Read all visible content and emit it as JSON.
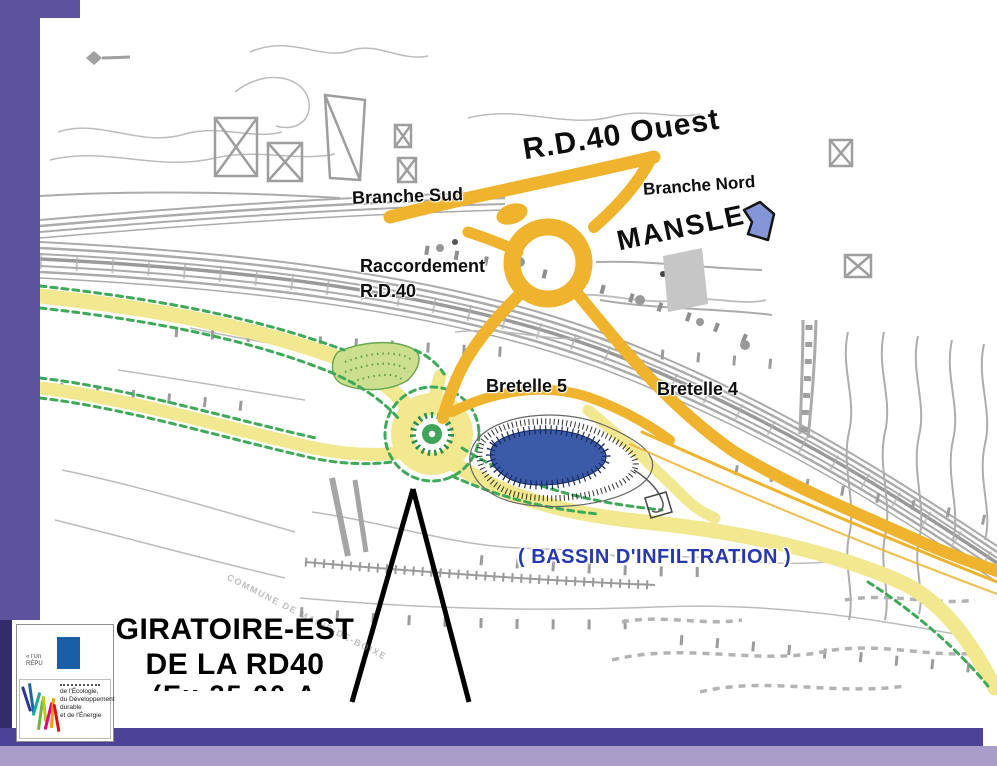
{
  "slide": {
    "frame_colors": {
      "band_purple": "#5C529E",
      "strip_dark_purple": "#332C6B",
      "bottom_bar_dark": "#4C4297",
      "bottom_bar_light": "#A99EC9"
    }
  },
  "map": {
    "labels": {
      "rd40_ouest": "R.D.40 Ouest",
      "branche_sud": "Branche Sud",
      "branche_nord": "Branche Nord",
      "mansle": "MANSLE",
      "raccordement_line1": "Raccordement",
      "raccordement_line2": "R.D.40",
      "bretelle_5": "Bretelle 5",
      "bretelle_4": "Bretelle 4",
      "bassin": "( BASSIN D'INFILTRATION )",
      "watermark": "COMMUNE DE MAINE-DE-BOIXE"
    },
    "title": {
      "line1": "GIRATOIRE-EST",
      "line2": "DE LA RD40",
      "line3_clipped": "(Ex 25.00.A"
    },
    "feature_colors": {
      "new_link_amber": "#EFB32D",
      "project_road_yellow": "#F2E88F",
      "landscape_green": "#3FA95A",
      "island_green_fill": "#CBDF8E",
      "basin_blue": "#3B5BA8",
      "bassin_label_blue": "#2638B0",
      "mansle_arrow_blue": "#8495D8",
      "existing_linework_gray": "#ABABAB"
    }
  },
  "logo": {
    "motto_line1": "« l'Un",
    "motto_line2": "RÉPU",
    "ministry_line1": "de l'Écologie,",
    "ministry_line2": "du Développement",
    "ministry_line3": "durable",
    "ministry_line4": "et de l'Énergie"
  }
}
